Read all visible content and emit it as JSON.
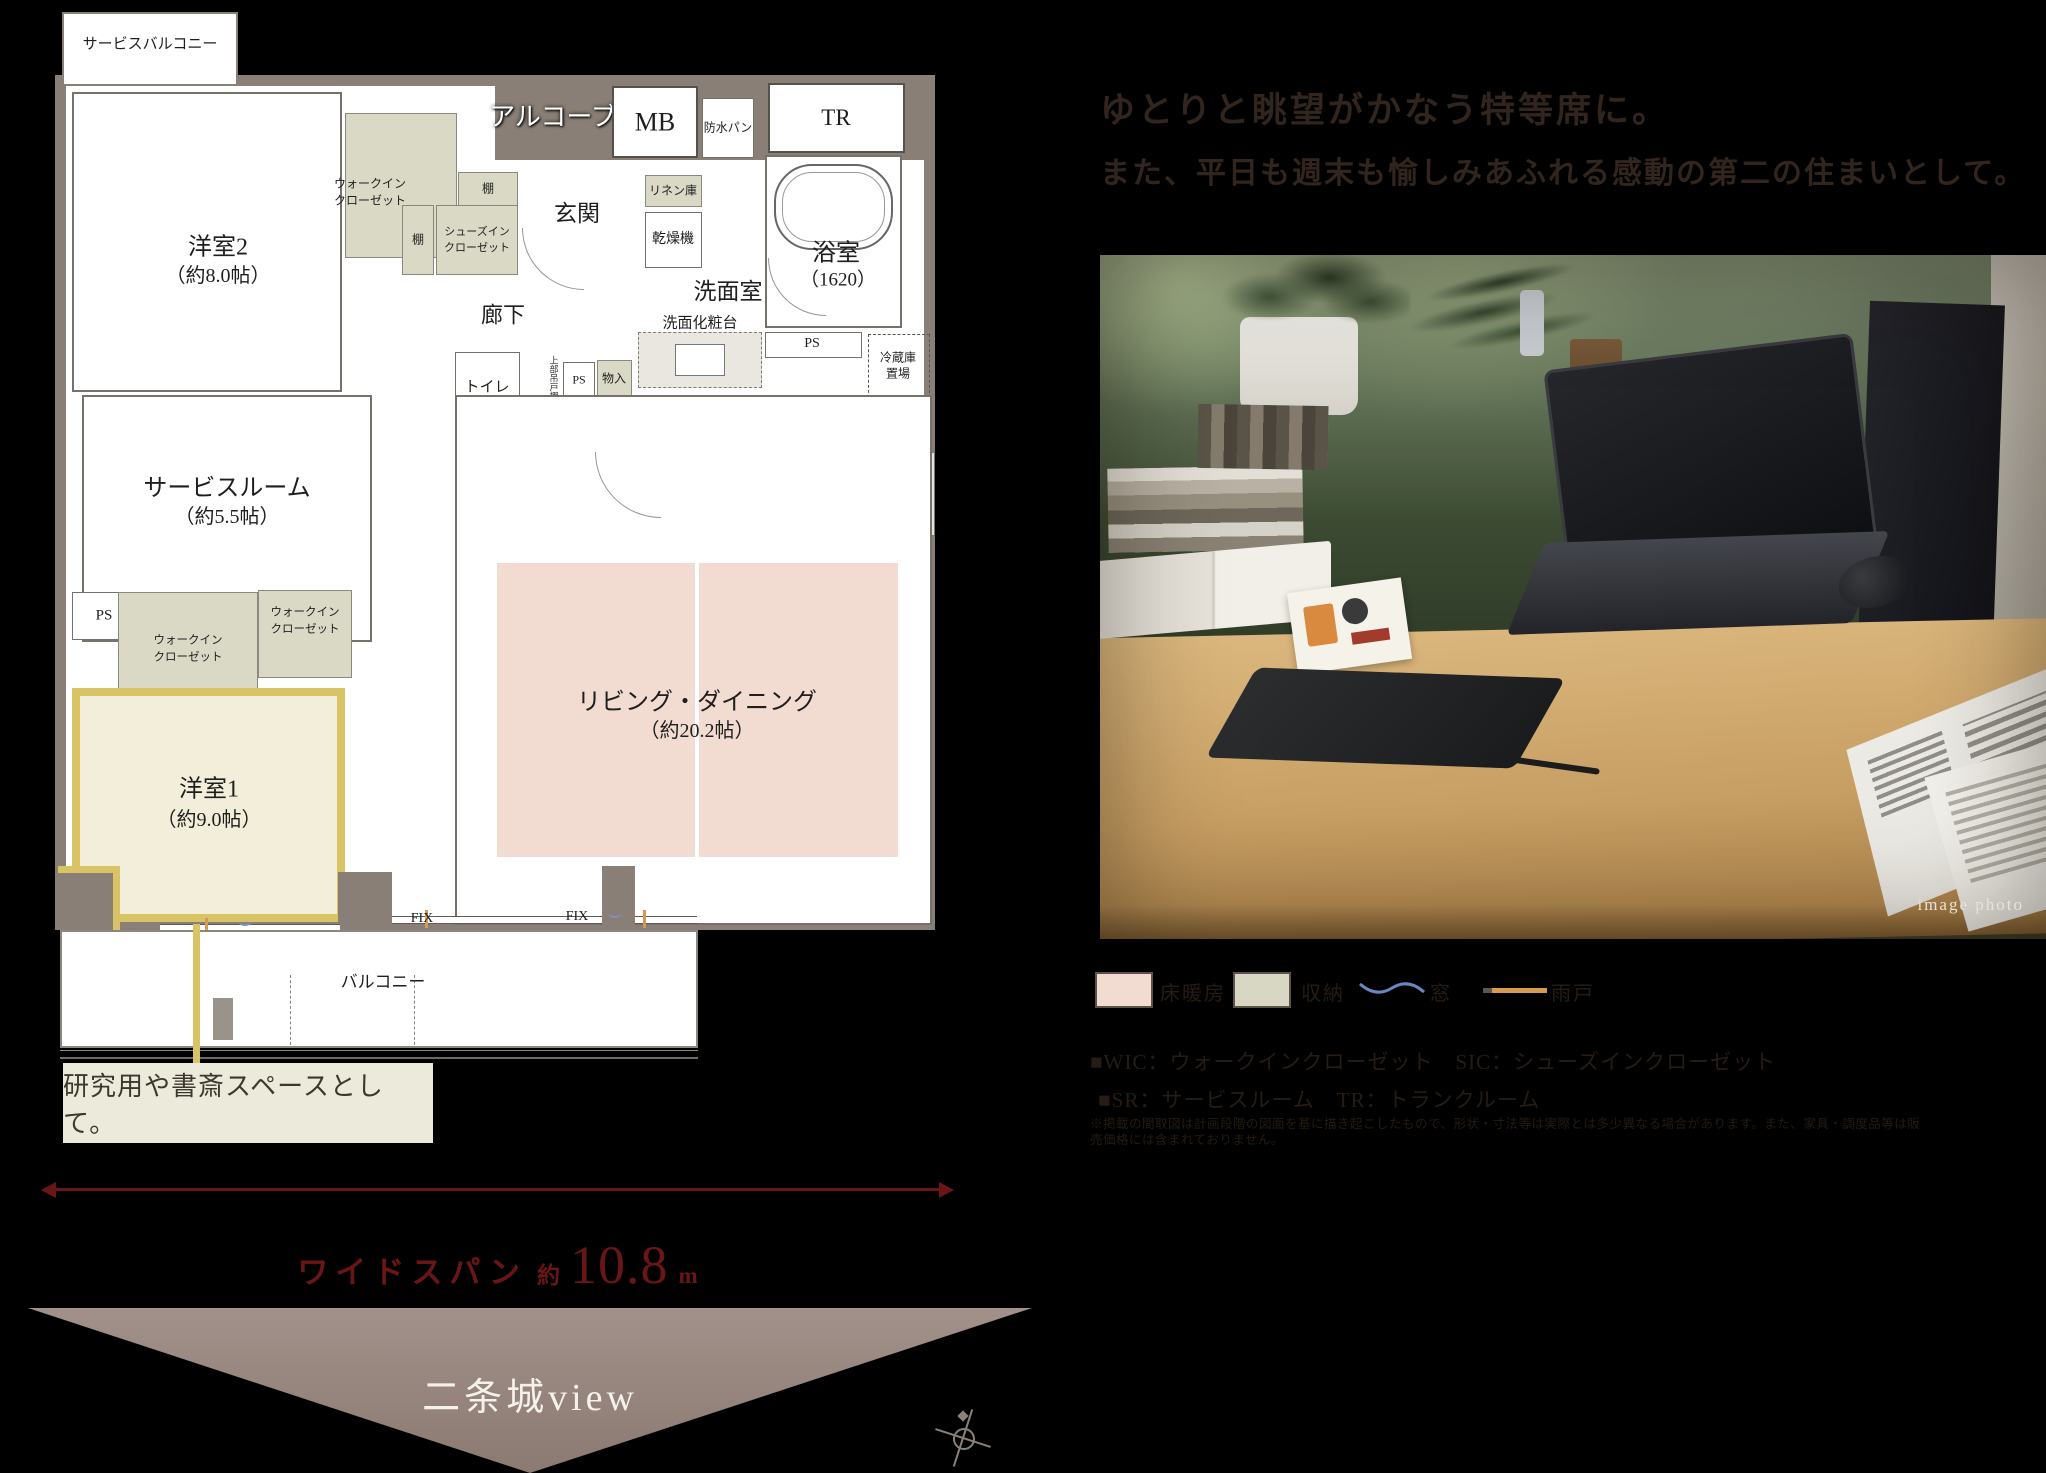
{
  "headline": {
    "line1": "ゆとりと眺望がかなう特等席に。",
    "line2": "また、平日も週末も愉しみあふれる感動の第二の住まいとして。",
    "color": "#31251d"
  },
  "plan": {
    "service_balcony": "サービスバルコニー",
    "alcove": "アルコーブ",
    "mb": "MB",
    "waterproof_pan": "防水パン",
    "tr": "TR",
    "entrance": "玄関",
    "linen": "リネン庫",
    "dryer": "乾燥機",
    "bathroom": "浴室",
    "bathroom_size": "（1620）",
    "washroom": "洗面室",
    "vanity": "洗面化粧台",
    "hallway": "廊下",
    "toilet": "トイレ",
    "upper_cabinet": "上部吊戸棚",
    "ps": "PS",
    "storage": "物入",
    "kitchen": "キッチン",
    "kitchen_size": "（約3.7帖）",
    "fridge_l1": "冷蔵庫",
    "fridge_l2": "置場",
    "counter": "カウンター",
    "bedroom2": "洋室2",
    "bedroom2_size": "（約8.0帖）",
    "service_room": "サービスルーム",
    "service_room_size": "（約5.5帖）",
    "bedroom1": "洋室1",
    "bedroom1_size": "（約9.0帖）",
    "ld": "リビング・ダイニング",
    "ld_size": "（約20.2帖）",
    "wic_l1": "ウォークイン",
    "wic_l2": "クローゼット",
    "sic_l1": "シューズイン",
    "sic_l2": "クローゼット",
    "shelf": "棚",
    "fix": "FIX",
    "balcony": "バルコニー"
  },
  "callout": {
    "text": "研究用や書斎スペースとして。",
    "accent_color": "#d9c465",
    "bg": "#eceada"
  },
  "measure": {
    "label": "ワイドスパン",
    "approx": "約",
    "value": "10.8",
    "unit": "m",
    "color": "#6a1616"
  },
  "view": {
    "label": "二条城view",
    "triangle_color": "#9c8b83"
  },
  "photo": {
    "caption": "image photo"
  },
  "legend": {
    "items": [
      {
        "label": "床暖房",
        "type": "swatch",
        "color": "#f2dcd1"
      },
      {
        "label": "収納",
        "type": "swatch",
        "color": "#d7d7c3"
      },
      {
        "label": "窓",
        "type": "wave",
        "color": "#6c86c0"
      },
      {
        "label": "雨戸",
        "type": "line",
        "color": "#d89a4e"
      }
    ]
  },
  "notes": {
    "line1": "■WIC：ウォークインクローゼット　SIC：シューズインクローゼット",
    "line2": "■SR：サービスルーム　TR：トランクルーム",
    "disclaimer": "※掲載の間取図は計画段階の図面を基に描き起こしたもので、形状・寸法等は実際とは多少異なる場合があります。また、家具・調度品等は販売価格には含まれておりません。"
  }
}
